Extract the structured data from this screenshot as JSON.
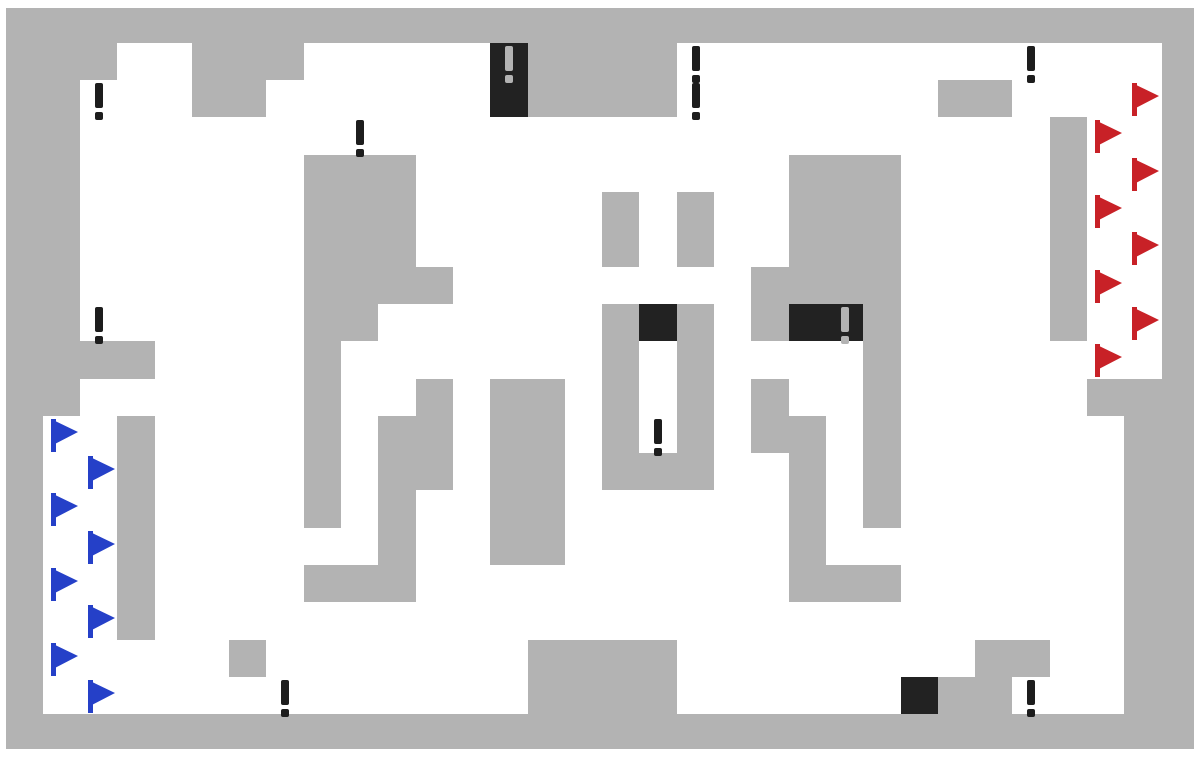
{
  "game": {
    "title": "capture-the-flag-grid-map",
    "grid": {
      "cols": 32,
      "rows": 20,
      "tile_width": 37.3,
      "tile_height": 37.3,
      "origin_x": 5.4,
      "origin_y": 5.5
    },
    "margins": {
      "top": 8,
      "left": 6,
      "right": 6,
      "bottom": 8
    },
    "colors": {
      "background": "#ffffff",
      "wall": "#b3b3b3",
      "black_tile": "#222222",
      "mark_dark": "#1d1d1d",
      "mark_light": "#b3b3b3",
      "blue_flag": "#2540c8",
      "red_flag": "#c82127"
    },
    "legend": {
      ".": "empty",
      "W": "wall",
      "B": "black-tile",
      "b": "black-tile-with-mark",
      "!": "exclamation-mark",
      "f": "blue-flag",
      "r": "red-flag"
    },
    "tiles": [
      "WWWWWWWWWWWWWWWWWWWWWWWWWWWWWWWW",
      "WWW..WWW.....bWWWW!........!...W",
      "WW!..WW......BWWWW!......WW...rW",
      "WW.......!..................Wr.W",
      "WW......WWW..........WWW....W.rW",
      "WW......WWW.....W.W..WWW....Wr.W",
      "WW......WWW.....W.W..WWW....W.rW",
      "WW......WWWW........WWWW....Wr.W",
      "WW!.....WW......WBW.WBbW....W.rW",
      "WWWW....W.......W.W....W.....r.W",
      "WW......W..W.WW.W.W.W..W.....WWW",
      "Wf.W....W.WW.WW.W!W.WW.W......WW",
      "W.fW....W.WW.WW.WWW..W.W......WW",
      "Wf.W....W.W..WW......W.W......WW",
      "W.fW......W..WW......W........WW",
      "Wf.W....WWW..........WWW......WW",
      "W.fW..........................WW",
      "Wf....W.......WWWW........WW..WW",
      "W.f....!......WWWW......BWW!..WW",
      "WWWWWWWWWWWWWWWWWWWWWWWWWWWWWWWW"
    ],
    "counts": {
      "blue_flags": 8,
      "red_flags": 8,
      "exclamation_marks_on_white": 9,
      "exclamation_marks_on_black": 2,
      "black_tiles": 6
    }
  }
}
